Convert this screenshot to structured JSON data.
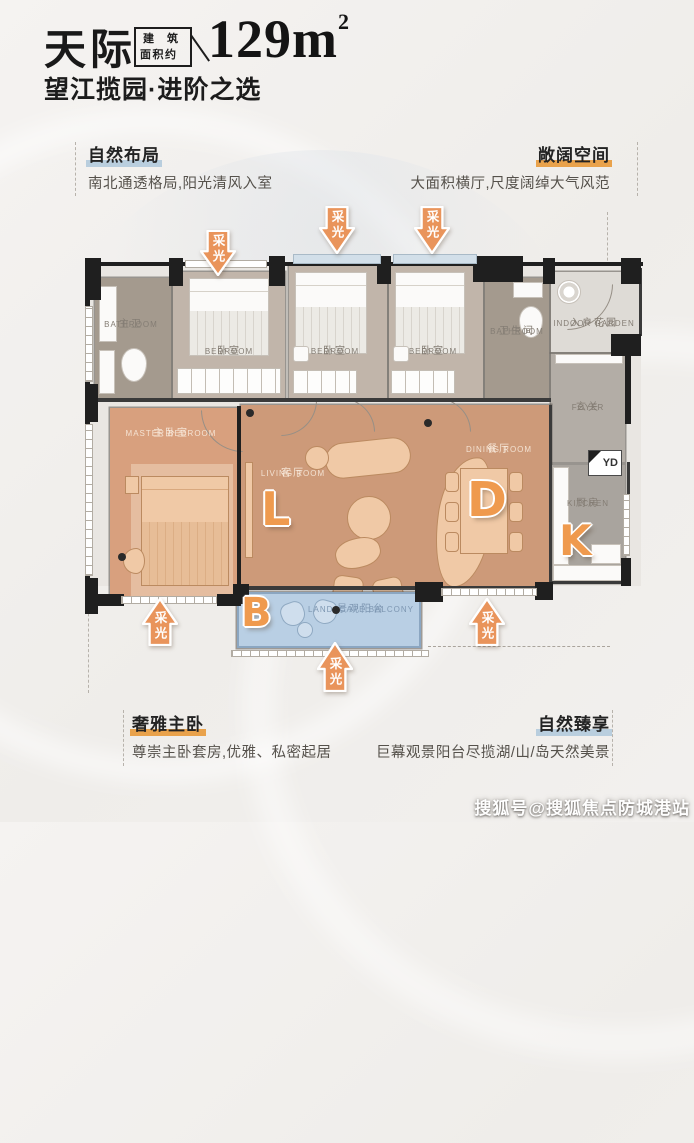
{
  "header": {
    "title": "天际",
    "area_box": {
      "line1": "建筑",
      "line2": "面积约"
    },
    "area_value": "129m",
    "area_superscript": "2",
    "subtitle": "望江揽园·进阶之选"
  },
  "features": {
    "natural_layout": {
      "title": "自然布局",
      "desc": "南北通透格局,阳光清风入室"
    },
    "spacious": {
      "title": "敞阔空间",
      "desc": "大面积横厅,尺度阔绰大气风范"
    },
    "master_suite": {
      "title": "奢雅主卧",
      "desc": "尊崇主卧套房,优雅、私密起居"
    },
    "nature_enjoy": {
      "title": "自然臻享",
      "desc": "巨幕观景阳台尽揽湖/山/岛天然美景"
    }
  },
  "floorplan": {
    "light_arrow_label": "采光",
    "rooms": {
      "master_bathroom": {
        "zh": "主卫",
        "en": "BATHROOM"
      },
      "bedroom_left": {
        "zh": "卧室",
        "en": "BEDROOM"
      },
      "bedroom_mid": {
        "zh": "卧室",
        "en": "BEDROOM"
      },
      "bedroom_right": {
        "zh": "卧室",
        "en": "BEDROOM"
      },
      "bathroom": {
        "zh": "卫生间",
        "en": "BATHROOM"
      },
      "indoor_garden": {
        "zh": "入户花园",
        "en": "INDOOR GARDEN"
      },
      "foyer": {
        "zh": "玄关",
        "en": "FOYER"
      },
      "master_bedroom": {
        "zh": "主卧室",
        "en": "MASTER BEDROOM"
      },
      "living_room": {
        "zh": "客厅",
        "en": "LIVING ROOM",
        "letter": "L"
      },
      "dining_room": {
        "zh": "餐厅",
        "en": "DINING ROOM",
        "letter": "D"
      },
      "kitchen": {
        "zh": "厨房",
        "en": "KITCHEN",
        "letter": "K"
      },
      "balcony": {
        "zh": "景观阳台",
        "en": "LANDSCAPE BALCONY",
        "letter": "B"
      },
      "yd": {
        "label": "YD"
      }
    }
  },
  "watermark": "搜狐号@搜狐焦点防城港站",
  "colors": {
    "accent_orange": "#e9a24b",
    "accent_blue": "#b9cede",
    "arrow_orange": "#e9945b",
    "letter_orange": "#ef9a4e",
    "floor_warm": "#cd9a79",
    "floor_master": "#d8a07e",
    "floor_wood": "#c1b5aa",
    "floor_bath": "#a49a8e",
    "balcony_blue": "#b9cfe4",
    "wall_black": "#1f1f1f"
  }
}
